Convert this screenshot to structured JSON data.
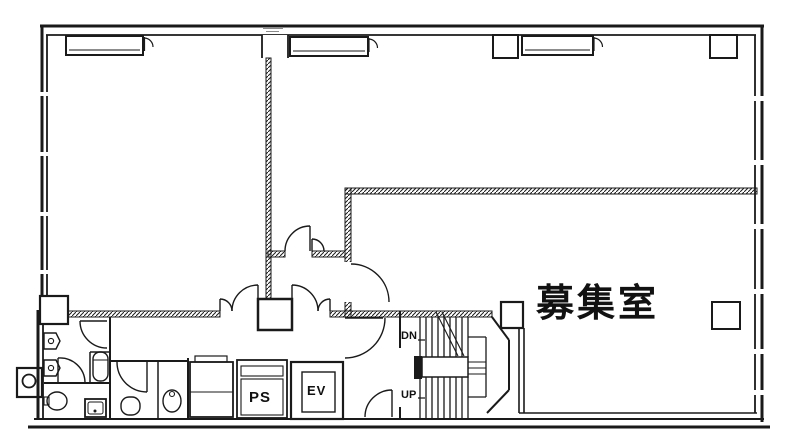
{
  "page": {
    "background_color": "#ffffff",
    "line_color": "#1a1a1a",
    "description_type": "building floor plan"
  },
  "floor_plan": {
    "room_label": "募集室",
    "stairs": {
      "down_label": "DN",
      "up_label": "UP"
    },
    "utilities": {
      "pipe_space_label": "PS",
      "elevator_label": "EV"
    }
  }
}
